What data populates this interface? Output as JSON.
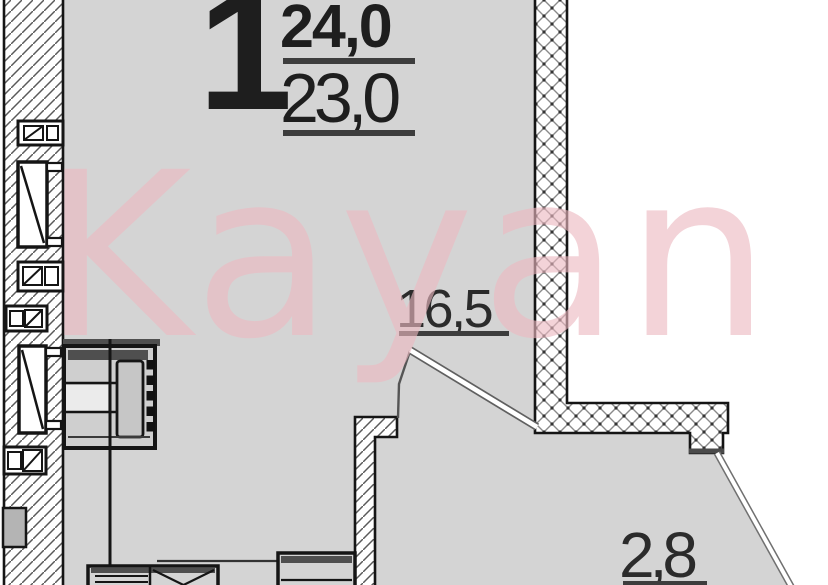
{
  "plan": {
    "rooms_count": "1",
    "area_total": "24,0",
    "area_living": "23,0",
    "living_room_area": "16,5",
    "balcony_area": "2,8"
  },
  "watermark": {
    "text": "Kayan"
  },
  "colors": {
    "floor_gray": "#d4d4d4",
    "wall_outline": "#151515",
    "hatch_line": "#5a5a5a",
    "underline": "#3d3d3d",
    "label_text": "#1e1e1e",
    "watermark_pink": "#edb9c1",
    "dark_band": "#4f4f4f"
  },
  "icons": {
    "tall_window": "window-icon",
    "vent_box": "vent-box-icon",
    "duct_block": "duct-block-icon",
    "appliance": "washing-machine-icon",
    "sink": "kitchen-sink-icon",
    "cabinet": "kitchen-cabinet-icon",
    "glazing": "balcony-glazing-line",
    "railing": "balcony-railing-line"
  }
}
